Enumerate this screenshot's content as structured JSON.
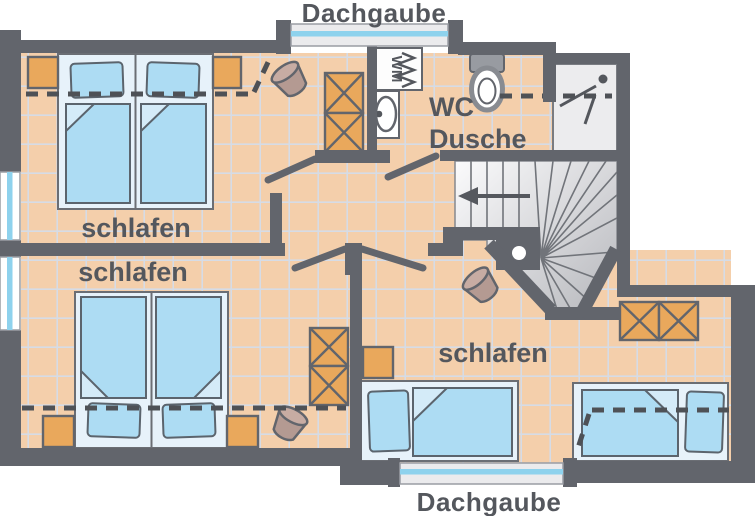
{
  "figure": {
    "type": "floor-plan",
    "subject": "upper floor with three bedrooms, bathroom and winder staircase"
  },
  "labels": {
    "dormer_top": "Dachgaube",
    "dormer_bottom": "Dachgaube",
    "room_top_left": "schlafen",
    "room_bottom_left": "schlafen",
    "room_bottom_right": "schlafen",
    "bathroom_line1": "WC",
    "bathroom_line2": "Dusche",
    "washing_machine": "WM"
  },
  "colors": {
    "wall": "#62656c",
    "floor_tile": "#f4cfab",
    "tile_grid": "#d6dce6",
    "bed_frame": "#e7f2fa",
    "bedding": "#addcf3",
    "bedding_fold": "#d4ebf8",
    "furniture_orange": "#e9a85c",
    "chair_brown": "#b49a92",
    "stair_light": "#fbfbfc",
    "stair_dark": "#b7b8bd",
    "shower_floor": "#ececee",
    "window_glass": "#8ed2ed",
    "dormer_band": "#ebebed",
    "text": "#54575d",
    "dash_line": "#4e5156"
  }
}
